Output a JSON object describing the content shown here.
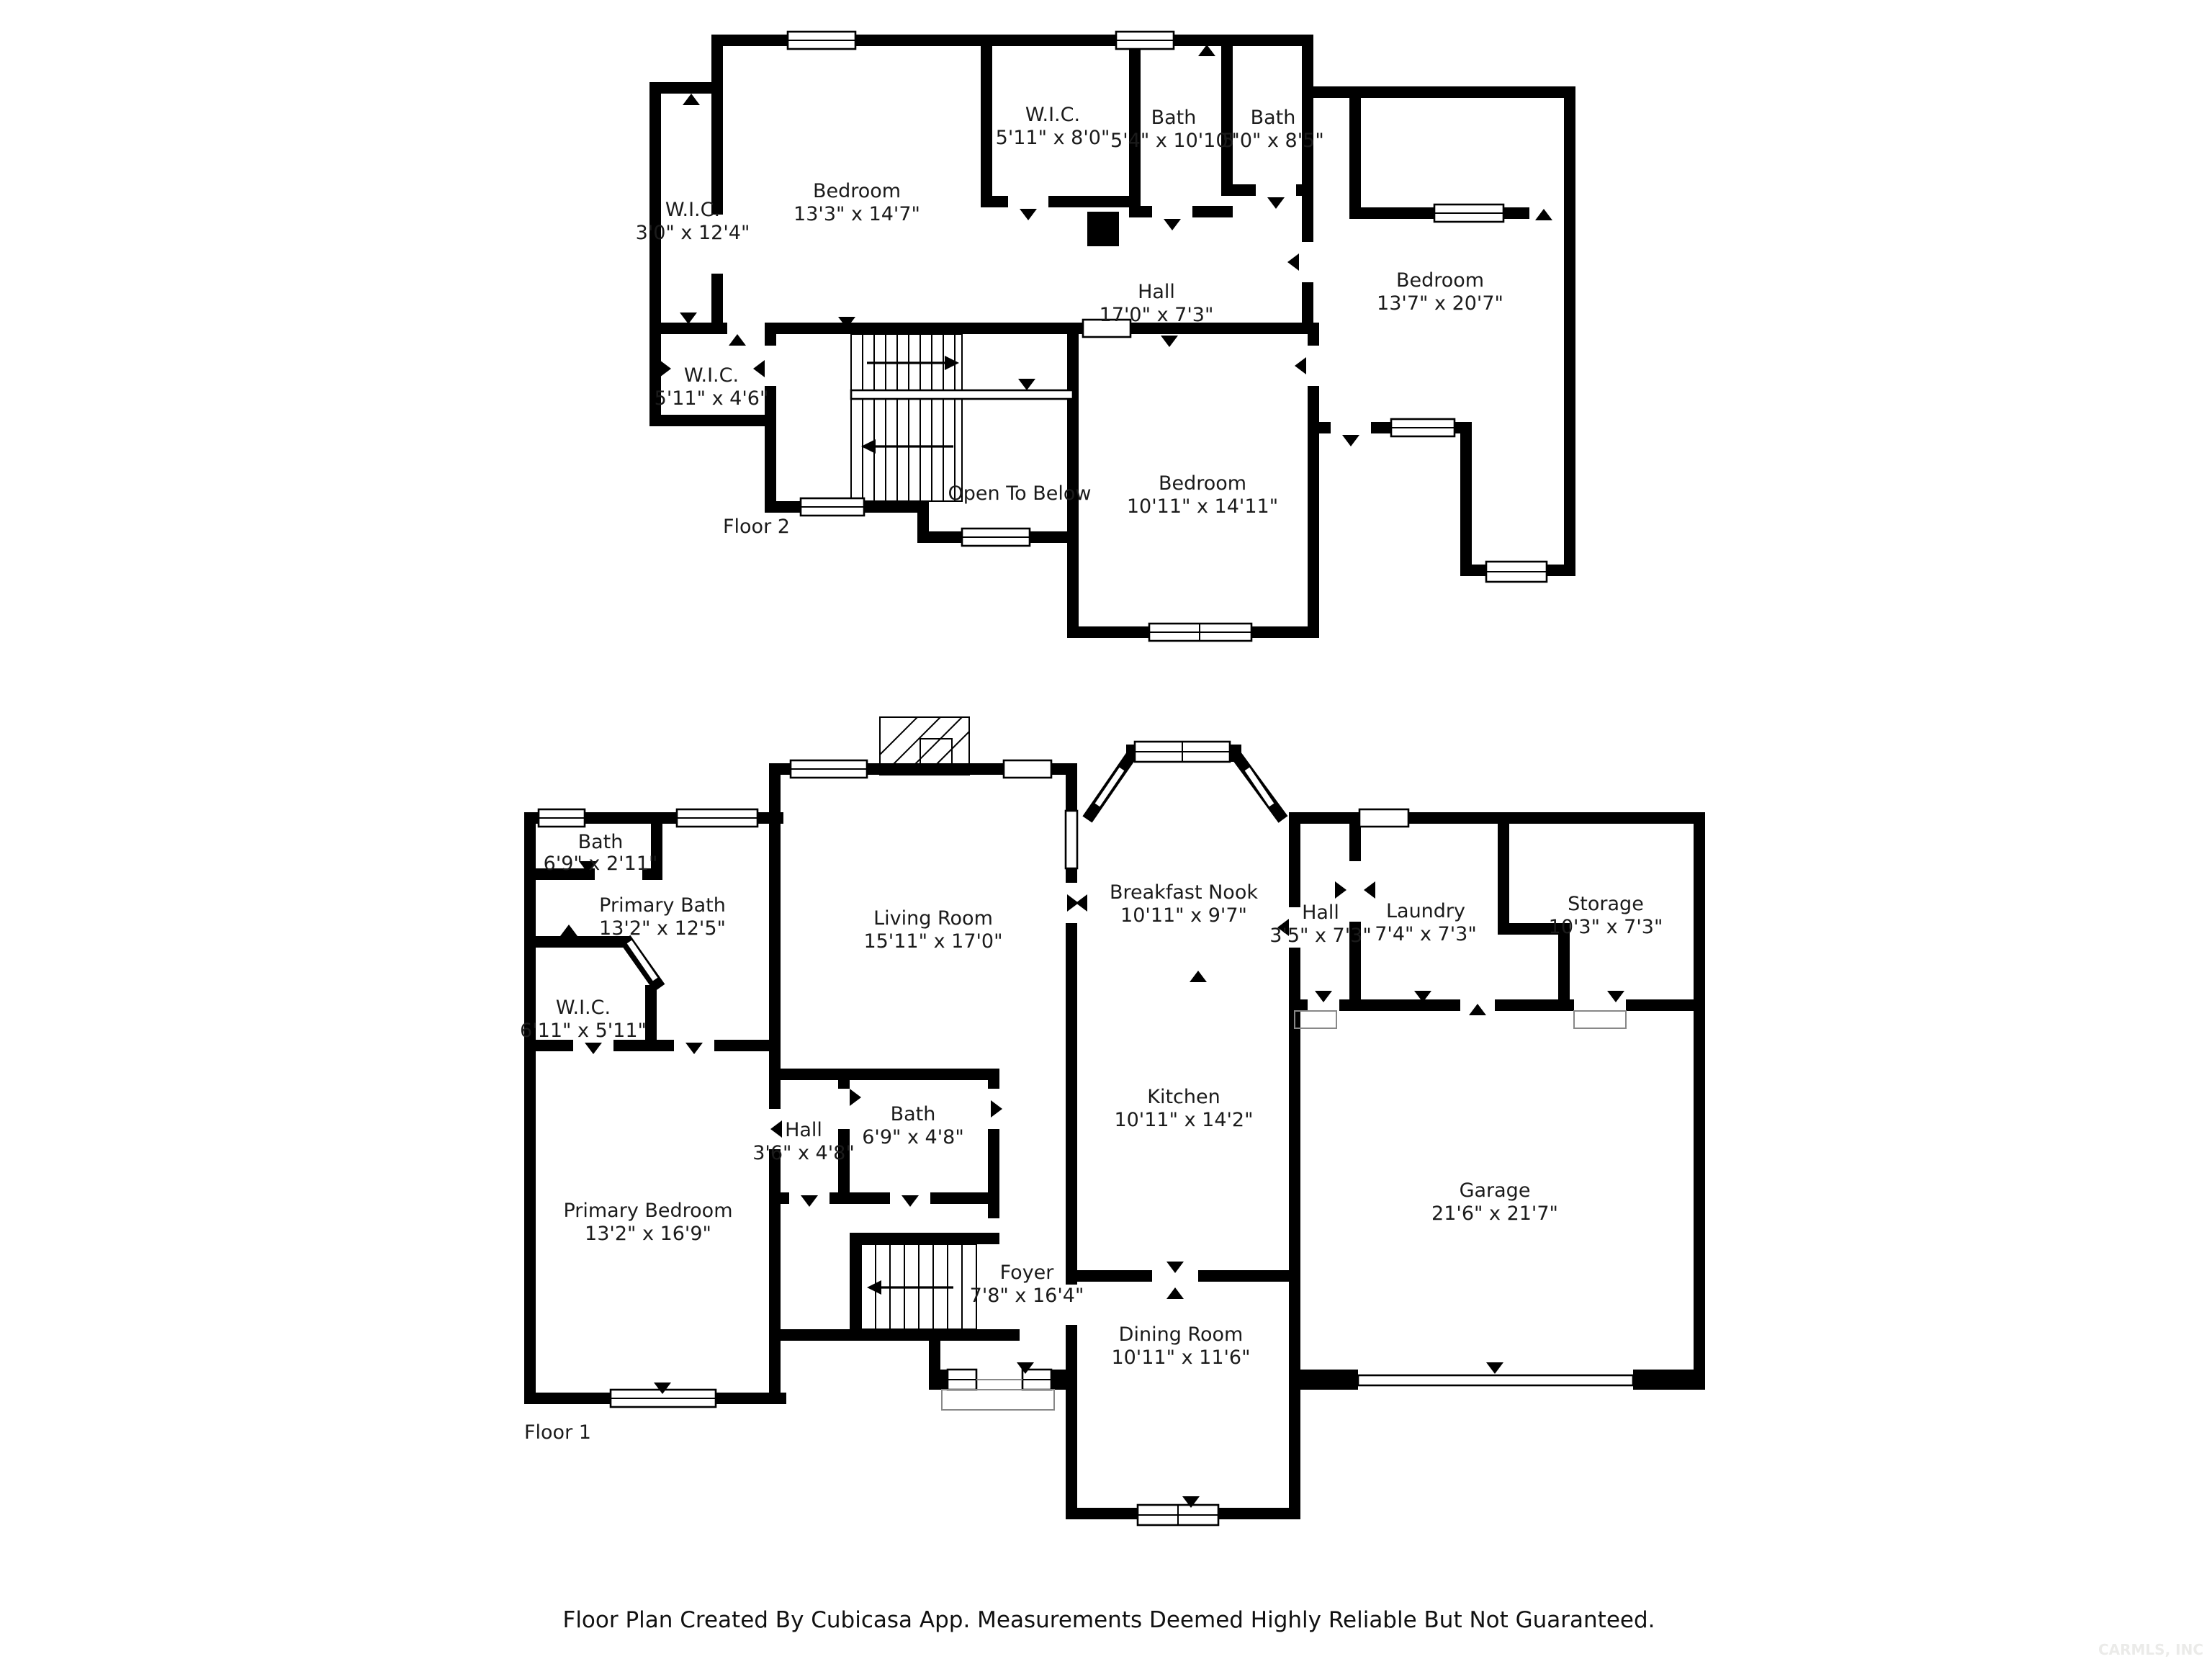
{
  "floors": [
    {
      "label": "Floor 2",
      "note": "Open To Below",
      "rooms": [
        {
          "name": "W.I.C.",
          "dims": "3'0\" x 12'4\""
        },
        {
          "name": "Bedroom",
          "dims": "13'3\" x 14'7\""
        },
        {
          "name": "W.I.C.",
          "dims": "5'11\" x 8'0\""
        },
        {
          "name": "Bath",
          "dims": "5'4\" x 10'10\""
        },
        {
          "name": "Bath",
          "dims": "5'0\" x 8'5\""
        },
        {
          "name": "Bedroom",
          "dims": "13'7\" x 20'7\""
        },
        {
          "name": "Hall",
          "dims": "17'0\" x 7'3\""
        },
        {
          "name": "W.I.C.",
          "dims": "5'11\" x 4'6\""
        },
        {
          "name": "Bedroom",
          "dims": "10'11\" x 14'11\""
        }
      ]
    },
    {
      "label": "Floor 1",
      "rooms": [
        {
          "name": "Bath",
          "dims": "6'9\" x 2'11\""
        },
        {
          "name": "Primary Bath",
          "dims": "13'2\" x 12'5\""
        },
        {
          "name": "W.I.C.",
          "dims": "6'11\" x 5'11\""
        },
        {
          "name": "Living Room",
          "dims": "15'11\" x 17'0\""
        },
        {
          "name": "Breakfast Nook",
          "dims": "10'11\" x 9'7\""
        },
        {
          "name": "Hall",
          "dims": "3'5\" x 7'3\""
        },
        {
          "name": "Laundry",
          "dims": "7'4\" x 7'3\""
        },
        {
          "name": "Storage",
          "dims": "10'3\" x 7'3\""
        },
        {
          "name": "Hall",
          "dims": "3'6\" x 4'8\""
        },
        {
          "name": "Bath",
          "dims": "6'9\" x 4'8\""
        },
        {
          "name": "Kitchen",
          "dims": "10'11\" x 14'2\""
        },
        {
          "name": "Foyer",
          "dims": "7'8\" x 16'4\""
        },
        {
          "name": "Primary Bedroom",
          "dims": "13'2\" x 16'9\""
        },
        {
          "name": "Garage",
          "dims": "21'6\" x 21'7\""
        },
        {
          "name": "Dining Room",
          "dims": "10'11\" x 11'6\""
        }
      ]
    }
  ],
  "footer": {
    "caption": "Floor Plan Created By Cubicasa App. Measurements Deemed Highly Reliable But Not Guaranteed."
  },
  "watermark": "CARMLS, INC"
}
